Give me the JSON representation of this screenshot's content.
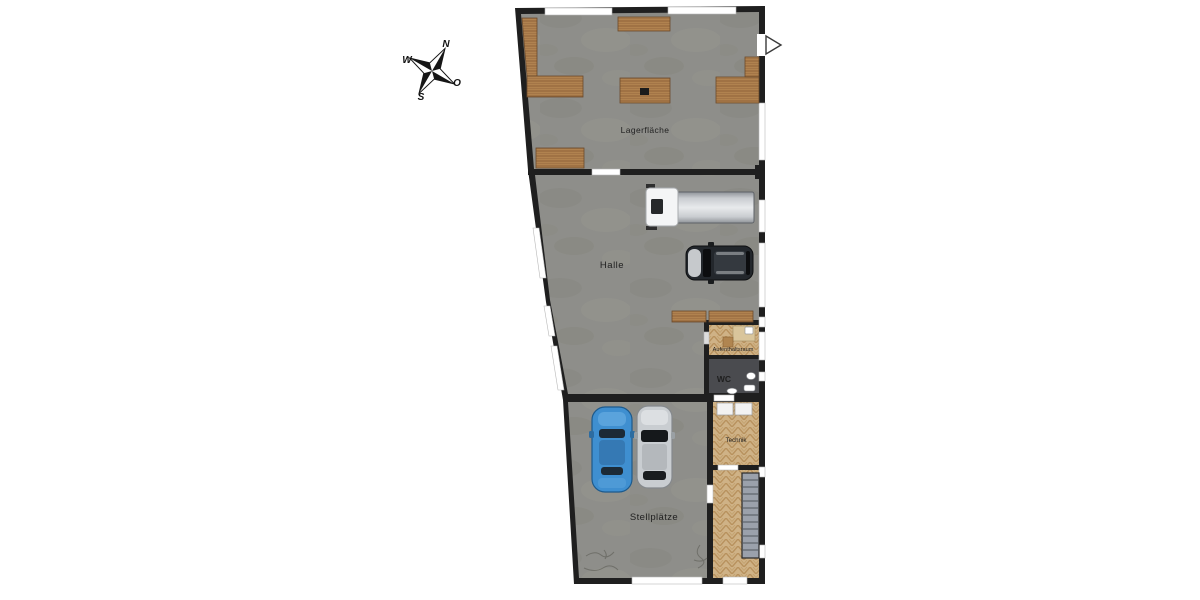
{
  "page": {
    "type": "floor-plan",
    "background": "#ffffff"
  },
  "compass": {
    "n": "N",
    "e": "O",
    "s": "S",
    "w": "W"
  },
  "rooms": {
    "lagerflaeche": {
      "label": "Lagerfläche"
    },
    "halle": {
      "label": "Halle"
    },
    "aufenthaltsraum": {
      "label": "Aufenthaltsraum"
    },
    "wc": {
      "label": "WC"
    },
    "technik": {
      "label": "Technik"
    },
    "stellplaetze": {
      "label": "Stellplätze"
    }
  },
  "vehicles": [
    {
      "name": "delivery-truck",
      "location": "Halle"
    },
    {
      "name": "dark-car",
      "location": "Halle"
    },
    {
      "name": "blue-car",
      "location": "Stellplätze"
    },
    {
      "name": "silver-car",
      "location": "Stellplätze"
    }
  ],
  "colors": {
    "wall": "#1f1f1f",
    "concrete": "#8e8e8a",
    "wood": "#ad7d4e",
    "parquet": "#cfb286",
    "wc_floor": "#4a4b4f",
    "stairs": "#9ba1ab",
    "window": "#ffffff",
    "car_blue": "#3f8fd0",
    "car_silver": "#c9cdd1",
    "car_dark": "#23272c",
    "truck_cab": "#f4f5f6"
  }
}
